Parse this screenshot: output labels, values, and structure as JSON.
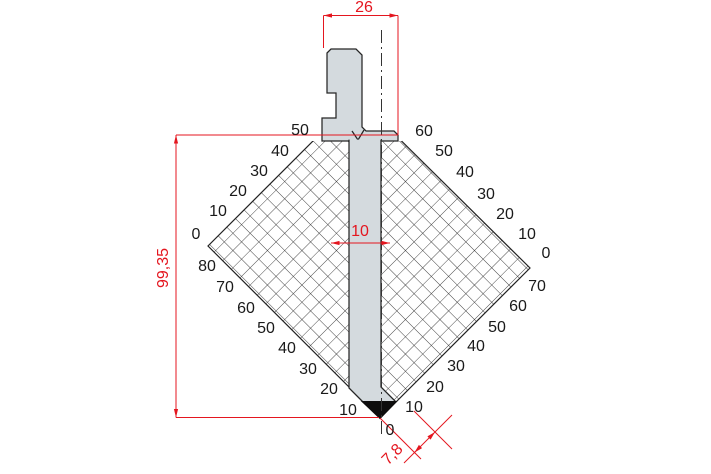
{
  "drawing": {
    "type": "press-brake punch technical drawing",
    "dimensions": {
      "top_width": "26",
      "left_height": "99,35",
      "stem_width": "10",
      "tip_offset": "7,8"
    },
    "scales": {
      "upper_left": [
        "50",
        "40",
        "30",
        "20",
        "10",
        "0"
      ],
      "lower_left": [
        "80",
        "70",
        "60",
        "50",
        "40",
        "30",
        "20",
        "10"
      ],
      "upper_right": [
        "60",
        "50",
        "40",
        "30",
        "20",
        "10",
        "0"
      ],
      "lower_right": [
        "70",
        "60",
        "50",
        "40",
        "30",
        "20",
        "10",
        "0"
      ]
    },
    "colors": {
      "dimension_red": "#e4161f",
      "punch_fill": "#d4dade",
      "outline_dark": "#262626",
      "grid_line": "#3c3c3c",
      "tip_black": "#0d0d0d",
      "background": "#ffffff"
    }
  }
}
